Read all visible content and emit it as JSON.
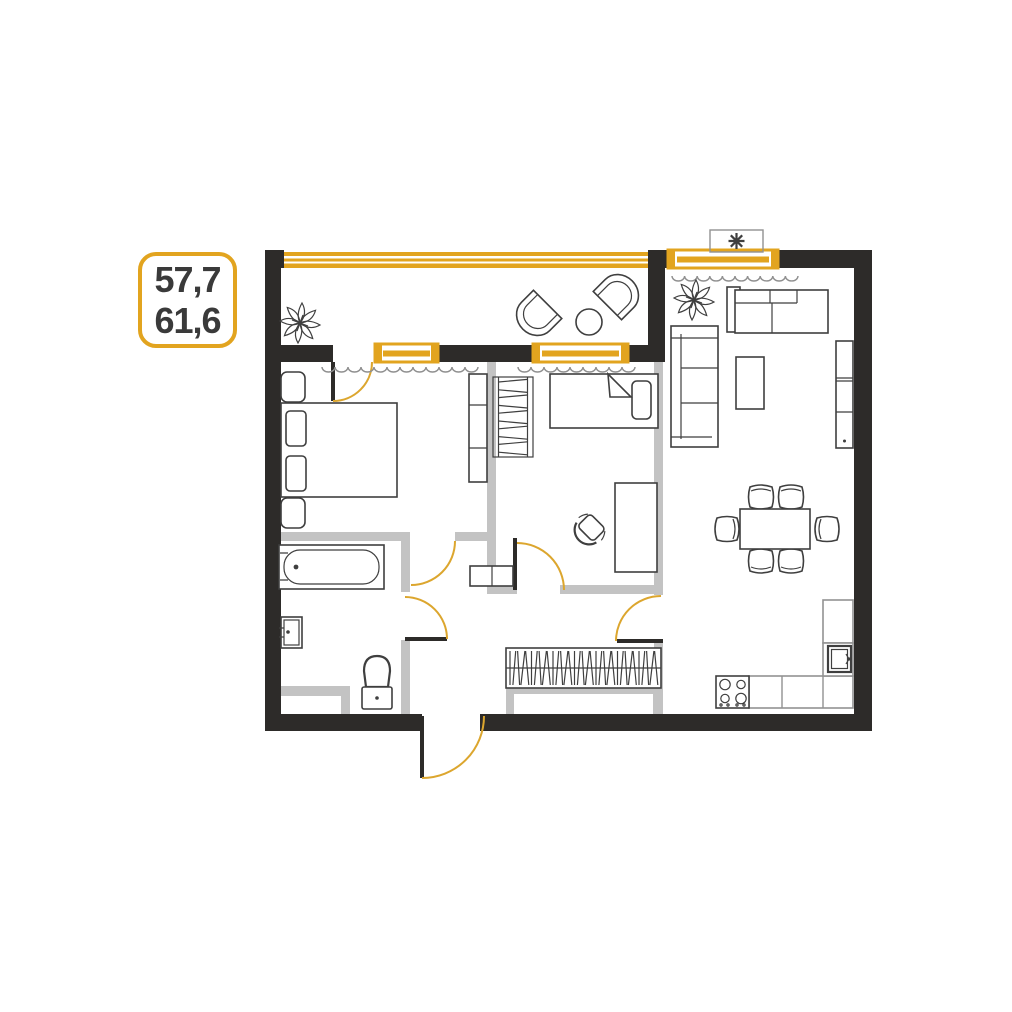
{
  "label": {
    "value_top": "57,7",
    "value_bottom": "61,6"
  },
  "colors": {
    "wall": "#2d2b29",
    "partition": "#c3c3c3",
    "accent": "#e2a41f",
    "accent_arc": "#dca62e",
    "outline": "#3f3f3f",
    "outline_light": "#929292",
    "curtain": "#8f8f8f",
    "text": "#3a3a3a",
    "bg": "#ffffff"
  },
  "floorplan": {
    "rooms": [
      "balcony",
      "bedroom-1",
      "bedroom-2",
      "bathroom",
      "hallway",
      "living-room-kitchen"
    ],
    "furniture": [
      "double-bed",
      "nightstands",
      "wardrobe",
      "single-bed",
      "desk",
      "office-chair",
      "shelf-rack",
      "bathtub",
      "wash-basin",
      "toilet",
      "hallway-wardrobe",
      "sofa",
      "corner-sofa",
      "coffee-table",
      "tv-stand",
      "dining-table",
      "dining-chairs",
      "kitchen-counter",
      "stove",
      "kitchen-sink",
      "balcony-armchairs",
      "side-table",
      "plants",
      "air-conditioner"
    ]
  }
}
